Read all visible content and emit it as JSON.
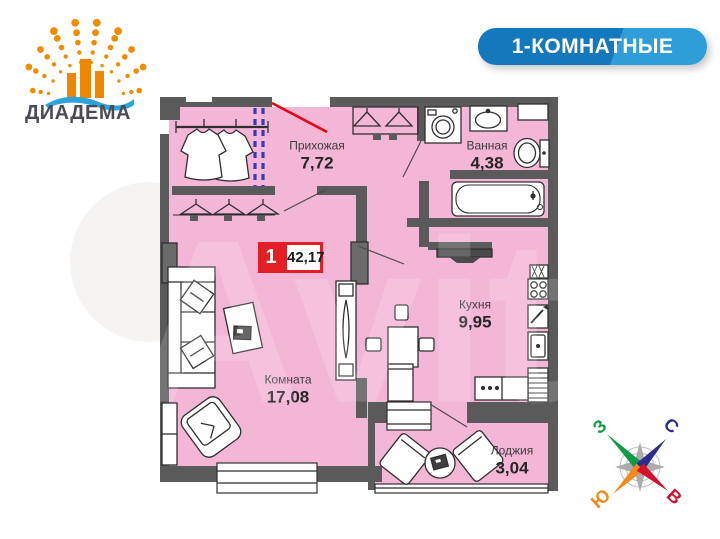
{
  "logo": {
    "brand": "ДИАДЕМА"
  },
  "header": {
    "badge": "1-КОМНАТНЫЕ"
  },
  "watermark": {
    "text": "Avito"
  },
  "plan": {
    "unit_badge": {
      "rooms": "1",
      "total_area": "42,17"
    },
    "rooms": [
      {
        "name": "Прихожая",
        "area": "7,72"
      },
      {
        "name": "Ванная",
        "area": "4,38"
      },
      {
        "name": "Кухня",
        "area": "9,95"
      },
      {
        "name": "Комната",
        "area": "17,08"
      },
      {
        "name": "Лоджия",
        "area": "3,04"
      }
    ]
  },
  "compass": {
    "west": "З",
    "north": "С",
    "south": "Ю",
    "east": "В"
  },
  "colors": {
    "floor_pink": "#f3b6d7",
    "wall_gray": "#5a5a5a",
    "entrance_red": "#e30613",
    "badge_red": "#e31f26",
    "badge_blue": "#1478bd",
    "badge_blue_light": "#2f9dd8",
    "logo_orange": "#f08c00",
    "logo_wave_blue": "#2ba3dc",
    "partition_dashed_blue": "#3a3ab8",
    "compass_west": "#0f9b44",
    "compass_north": "#2c2c8e",
    "compass_south": "#f18a1a",
    "compass_east": "#d40f2e"
  }
}
